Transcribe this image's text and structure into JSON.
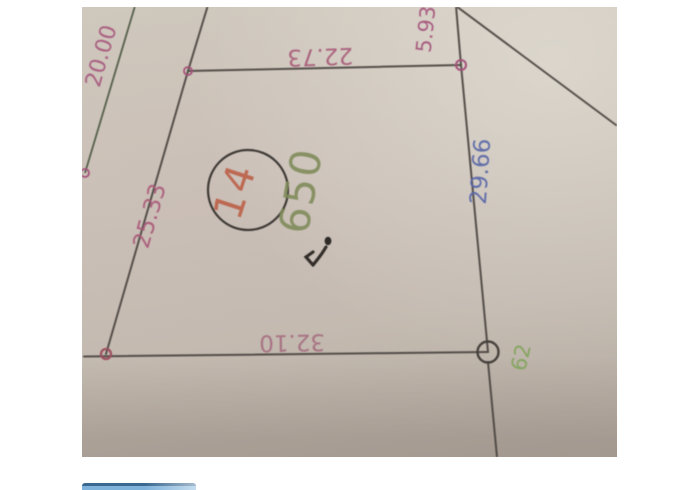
{
  "map": {
    "parcel": {
      "number": "14",
      "area": "650"
    },
    "dimensions": {
      "top": "22.73",
      "right": "29.66",
      "bottom": "32.10",
      "left": "25.33",
      "top_right_segment": "5.93",
      "adjacent_left": "20.00"
    },
    "point_label": "62",
    "colors": {
      "dimension_pink": "#a85a78",
      "dimension_blue": "#5a68a8",
      "point_green": "#82a45c",
      "area_olive": "#7e8a58",
      "parcel_number_red": "#bc6048",
      "line_dark": "#4a4440",
      "line_green": "#55604a",
      "paper": "#c9c1b7"
    }
  },
  "ui": {
    "bottom_button_label": ""
  }
}
